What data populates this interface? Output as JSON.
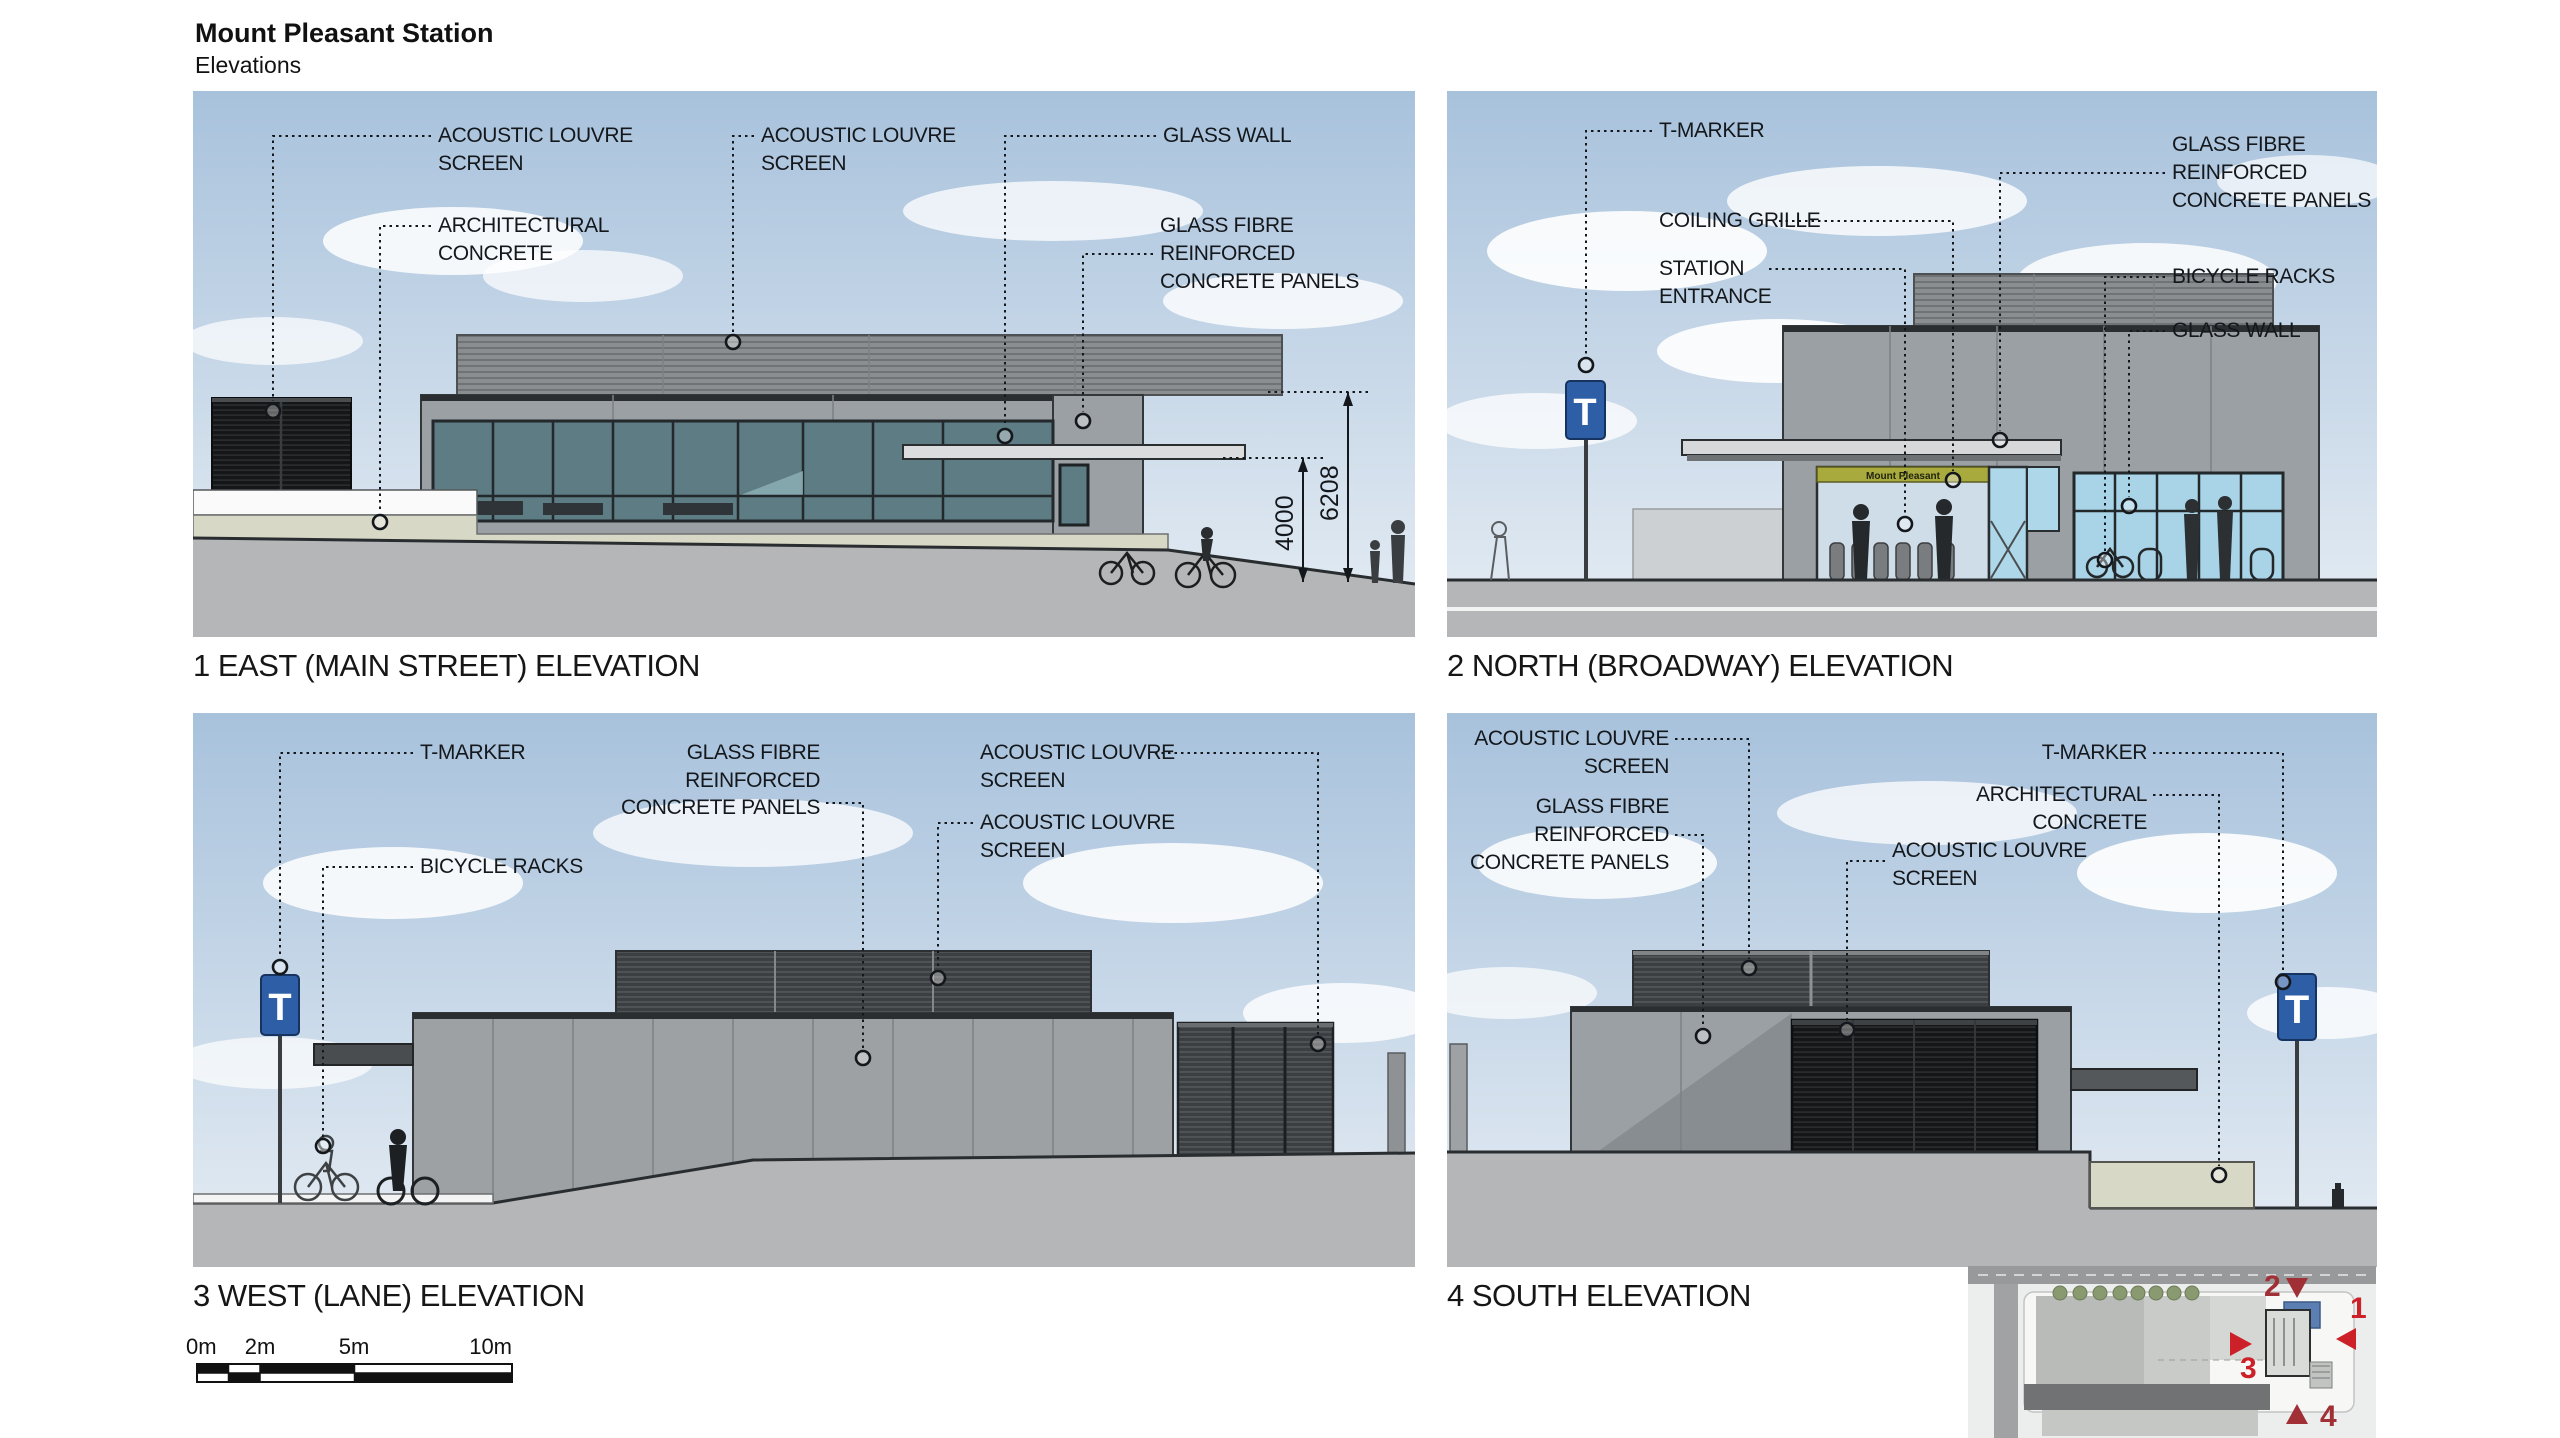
{
  "page": {
    "title": "Mount Pleasant Station",
    "subtitle": "Elevations"
  },
  "colors": {
    "sky_top": "#a8c2dc",
    "sky_bottom": "#e6edf4",
    "ground": "#b4b6b8",
    "concrete": "#9ba0a4",
    "concrete_beige": "#d8d8c6",
    "glass_teal": "#5d7c84",
    "glass_blue": "#a9d4e8",
    "louvre_black": "#161819",
    "louvre_gray": "#85888b",
    "canopy": "#dadcde",
    "tmarker_blue": "#2e5ea6",
    "sign_yellow": "#a9aa3d",
    "plan_red": "#cc2128",
    "plan_red_dark": "#a03036",
    "plan_roof_blue": "#5b7fb2"
  },
  "tmarker": {
    "letter": "T"
  },
  "elevations": {
    "east": {
      "caption": "1 EAST (MAIN STREET) ELEVATION",
      "labels": {
        "acoustic1a": "ACOUSTIC LOUVRE",
        "acoustic1b": "SCREEN",
        "acoustic2a": "ACOUSTIC LOUVRE",
        "acoustic2b": "SCREEN",
        "glass_wall": "GLASS WALL",
        "arch_a": "ARCHITECTURAL",
        "arch_b": "CONCRETE",
        "gfrc_a": "GLASS FIBRE",
        "gfrc_b": "REINFORCED",
        "gfrc_c": "CONCRETE PANELS",
        "dim_canopy": "4000",
        "dim_parapet": "6208"
      }
    },
    "north": {
      "caption": "2 NORTH (BROADWAY) ELEVATION",
      "labels": {
        "tmarker": "T-MARKER",
        "coiling": "COILING GRILLE",
        "station_a": "STATION",
        "station_b": "ENTRANCE",
        "gfrc_a": "GLASS FIBRE",
        "gfrc_b": "REINFORCED",
        "gfrc_c": "CONCRETE PANELS",
        "bikes": "BICYCLE RACKS",
        "glass_wall": "GLASS WALL",
        "sign": "Mount Pleasant"
      }
    },
    "west": {
      "caption": "3 WEST (LANE) ELEVATION",
      "labels": {
        "tmarker": "T-MARKER",
        "bikes": "BICYCLE RACKS",
        "gfrc_a": "GLASS FIBRE",
        "gfrc_b": "REINFORCED",
        "gfrc_c": "CONCRETE PANELS",
        "acoustic1a": "ACOUSTIC LOUVRE",
        "acoustic1b": "SCREEN",
        "acoustic2a": "ACOUSTIC LOUVRE",
        "acoustic2b": "SCREEN"
      }
    },
    "south": {
      "caption": "4 SOUTH ELEVATION",
      "labels": {
        "acoustic1a": "ACOUSTIC LOUVRE",
        "acoustic1b": "SCREEN",
        "gfrc_a": "GLASS FIBRE",
        "gfrc_b": "REINFORCED",
        "gfrc_c": "CONCRETE PANELS",
        "tmarker": "T-MARKER",
        "arch_a": "ARCHITECTURAL",
        "arch_b": "CONCRETE",
        "acoustic2a": "ACOUSTIC LOUVRE",
        "acoustic2b": "SCREEN"
      }
    }
  },
  "scale_bar": {
    "m0": "0m",
    "m2": "2m",
    "m5": "5m",
    "m10": "10m"
  },
  "site_plan": {
    "n1": "1",
    "n2": "2",
    "n3": "3",
    "n4": "4"
  }
}
